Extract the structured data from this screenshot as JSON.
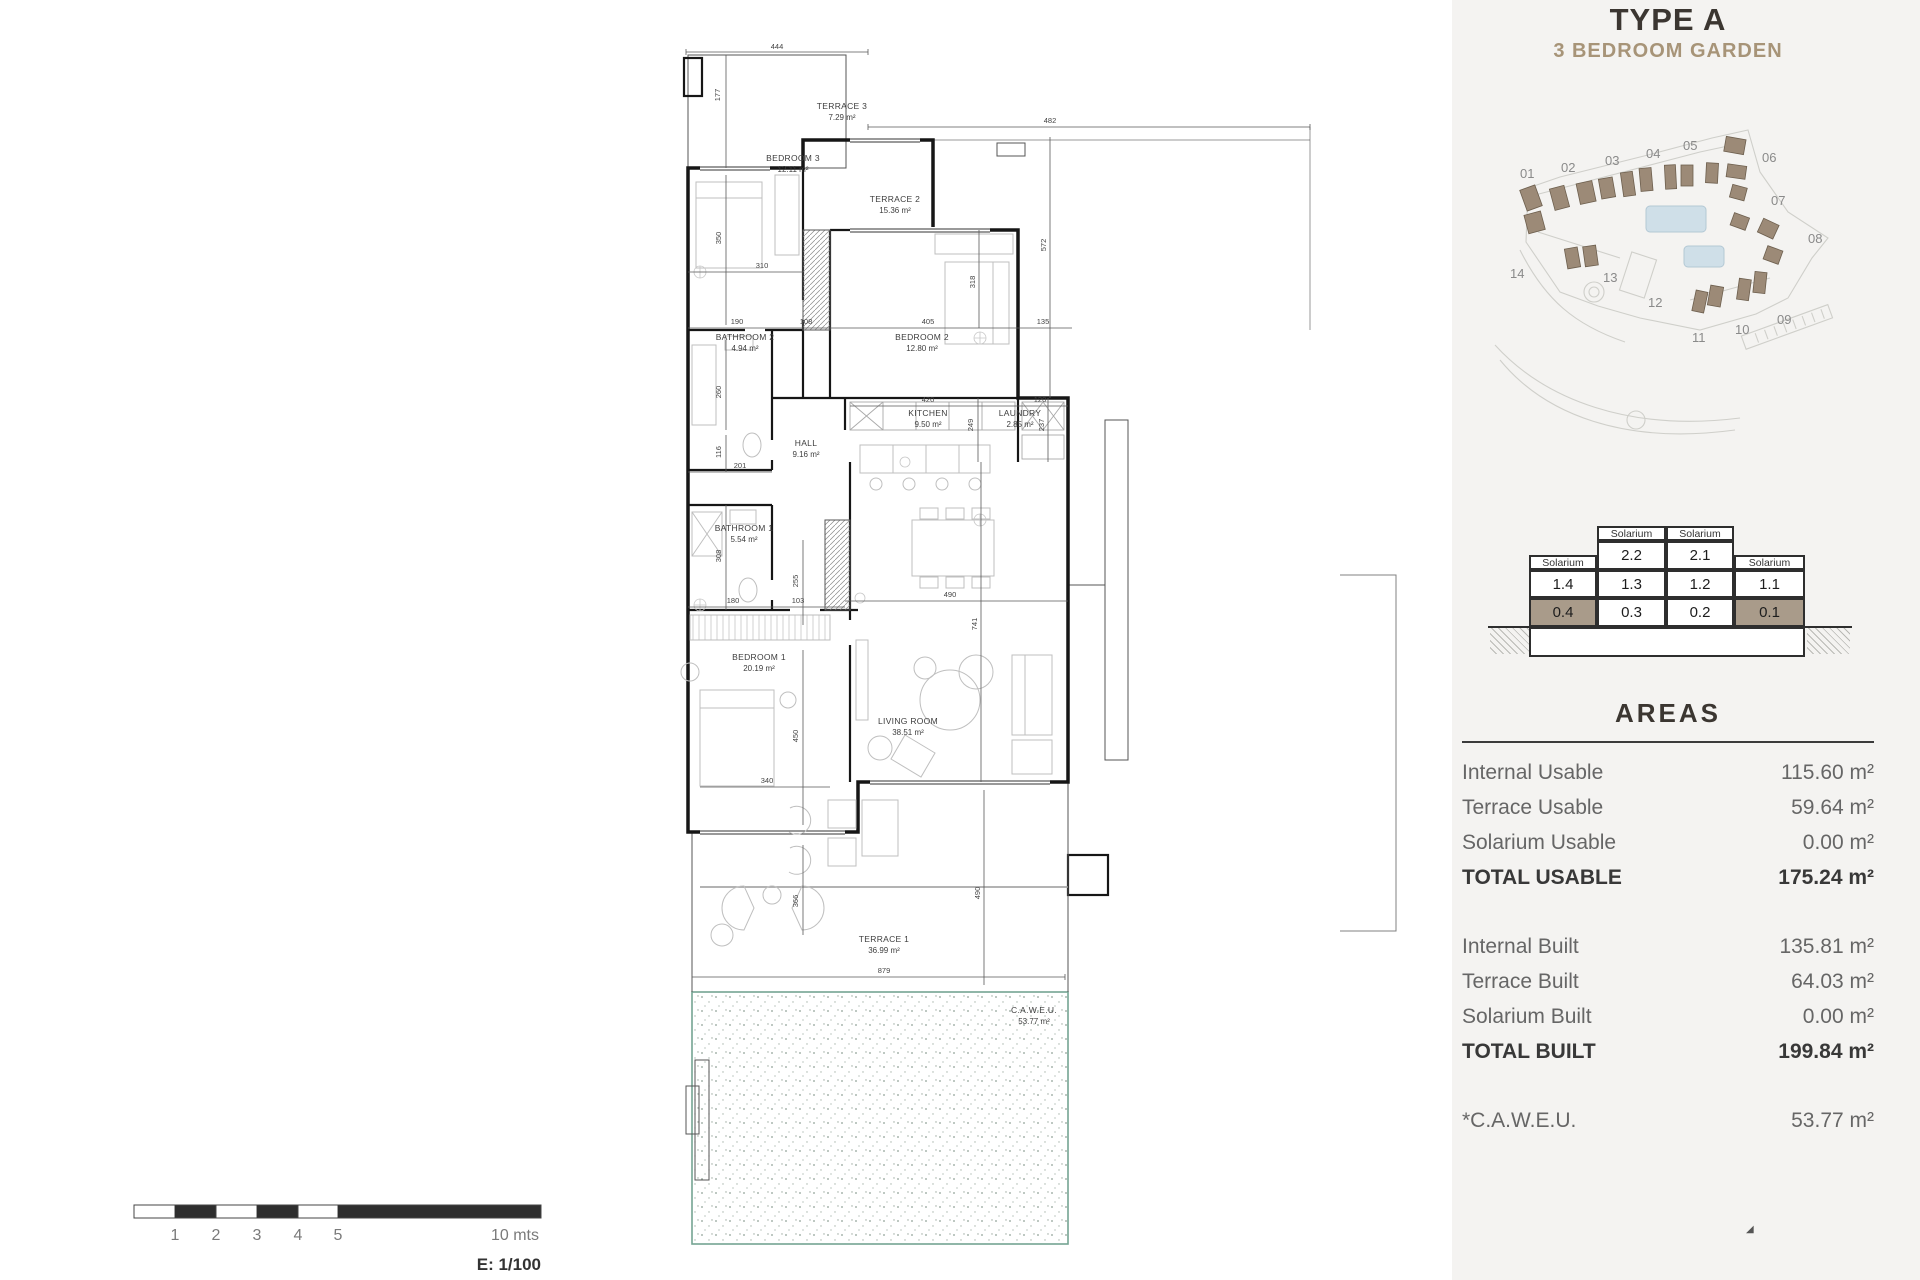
{
  "header": {
    "title": "TYPE A",
    "subtitle": "3 BEDROOM GARDEN"
  },
  "site_plan": {
    "numbers": [
      "01",
      "02",
      "03",
      "04",
      "05",
      "06",
      "07",
      "08",
      "09",
      "10",
      "11",
      "12",
      "13",
      "14"
    ]
  },
  "matrix": {
    "solarium": "Solarium",
    "floor2": [
      "2.2",
      "2.1"
    ],
    "floor1": [
      "1.4",
      "1.3",
      "1.2",
      "1.1"
    ],
    "floor0": [
      "0.4",
      "0.3",
      "0.2",
      "0.1"
    ]
  },
  "areas": {
    "heading": "AREAS",
    "usable": [
      {
        "label": "Internal Usable",
        "value": "115.60 m²"
      },
      {
        "label": "Terrace Usable",
        "value": "59.64 m²"
      },
      {
        "label": "Solarium Usable",
        "value": "0.00 m²"
      },
      {
        "label": "TOTAL USABLE",
        "value": "175.24 m²"
      }
    ],
    "built": [
      {
        "label": "Internal Built",
        "value": "135.81 m²"
      },
      {
        "label": "Terrace Built",
        "value": "64.03 m²"
      },
      {
        "label": "Solarium Built",
        "value": "0.00 m²"
      },
      {
        "label": "TOTAL BUILT",
        "value": "199.84 m²"
      }
    ],
    "caweu": {
      "label": "*C.A.W.E.U.",
      "value": "53.77 m²"
    }
  },
  "floor_plan": {
    "rooms": [
      {
        "name": "TERRACE 3",
        "area": "7.29 m²"
      },
      {
        "name": "BEDROOM 3",
        "area": "12.11 m²"
      },
      {
        "name": "TERRACE 2",
        "area": "15.36 m²"
      },
      {
        "name": "BATHROOM 2",
        "area": "4.94 m²"
      },
      {
        "name": "BEDROOM 2",
        "area": "12.80 m²"
      },
      {
        "name": "KITCHEN",
        "area": "9.50 m²"
      },
      {
        "name": "LAUNDRY",
        "area": "2.85 m²"
      },
      {
        "name": "HALL",
        "area": "9.16 m²"
      },
      {
        "name": "BATHROOM 1",
        "area": "5.54 m²"
      },
      {
        "name": "BEDROOM 1",
        "area": "20.19 m²"
      },
      {
        "name": "LIVING ROOM",
        "area": "38.51 m²"
      },
      {
        "name": "TERRACE 1",
        "area": "36.99 m²"
      },
      {
        "name": "C.A.W.E.U.",
        "area": "53.77 m²"
      }
    ],
    "dims": [
      "444",
      "177",
      "482",
      "572",
      "310",
      "350",
      "190",
      "108",
      "405",
      "135",
      "318",
      "420",
      "120",
      "249",
      "237",
      "116",
      "201",
      "308",
      "255",
      "180",
      "103",
      "490",
      "741",
      "450",
      "340",
      "366",
      "490",
      "879",
      "260"
    ]
  },
  "scale_bar": {
    "ticks": [
      "1",
      "2",
      "3",
      "4",
      "5"
    ],
    "end": "10 mts",
    "scale": "E: 1/100"
  },
  "colors": {
    "accent_tan": "#a79478",
    "highlight_cell": "#a99b8a",
    "garden_border": "#74a493",
    "pool": "#cfdfe8",
    "building": "#9c8a77"
  }
}
